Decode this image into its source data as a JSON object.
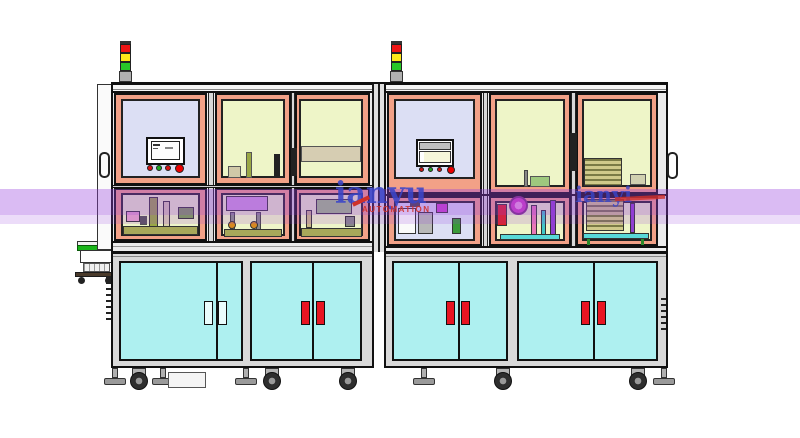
{
  "scene": {
    "width": 800,
    "height": 438,
    "background": "#ffffff",
    "description": "CAD render of a two-bay enclosed automation machine line with signal towers, HMI panels, machinery bays, cyan cabinet doors and casters"
  },
  "watermark": {
    "brand_text_main": "ianyu",
    "brand_text_right": "ianyi",
    "subtitle": "AUTOMATION",
    "band_color": "rgba(150,60,220,0.35)",
    "band_color_light": "rgba(150,60,220,0.18)",
    "text_color": "#3a45c8",
    "accent_color": "#d03028"
  },
  "palette": {
    "outline": "#111111",
    "frame_fill": "#ececec",
    "base_fill": "#d9d9d9",
    "panel_mat": "#f2a187",
    "window_lavender": "#dcdff4",
    "window_green": "#eef5c8",
    "door_cyan": "#aef0f0",
    "handle_red": "#e81522",
    "handle_pale": "#eafcfc",
    "belt_green": "#1ab51a"
  },
  "stack_light": {
    "segments": [
      {
        "name": "red",
        "color": "#ee1515"
      },
      {
        "name": "yellow",
        "color": "#ffe81a"
      },
      {
        "name": "green",
        "color": "#28c828"
      }
    ]
  },
  "hmi": {
    "buttons": [
      {
        "name": "red-button-1",
        "color": "#d81414"
      },
      {
        "name": "green-button",
        "color": "#1faa1f"
      },
      {
        "name": "red-button-2",
        "color": "#d81414"
      },
      {
        "name": "emergency-stop",
        "color": "#ee0000"
      }
    ]
  },
  "cabinet": {
    "pairs": [
      {
        "id": "left-1",
        "handle_color": "#eafcfc"
      },
      {
        "id": "left-2",
        "handle_color": "#e81522"
      },
      {
        "id": "right-1",
        "handle_color": "#e81522"
      },
      {
        "id": "right-2",
        "handle_color": "#e81522"
      }
    ]
  }
}
